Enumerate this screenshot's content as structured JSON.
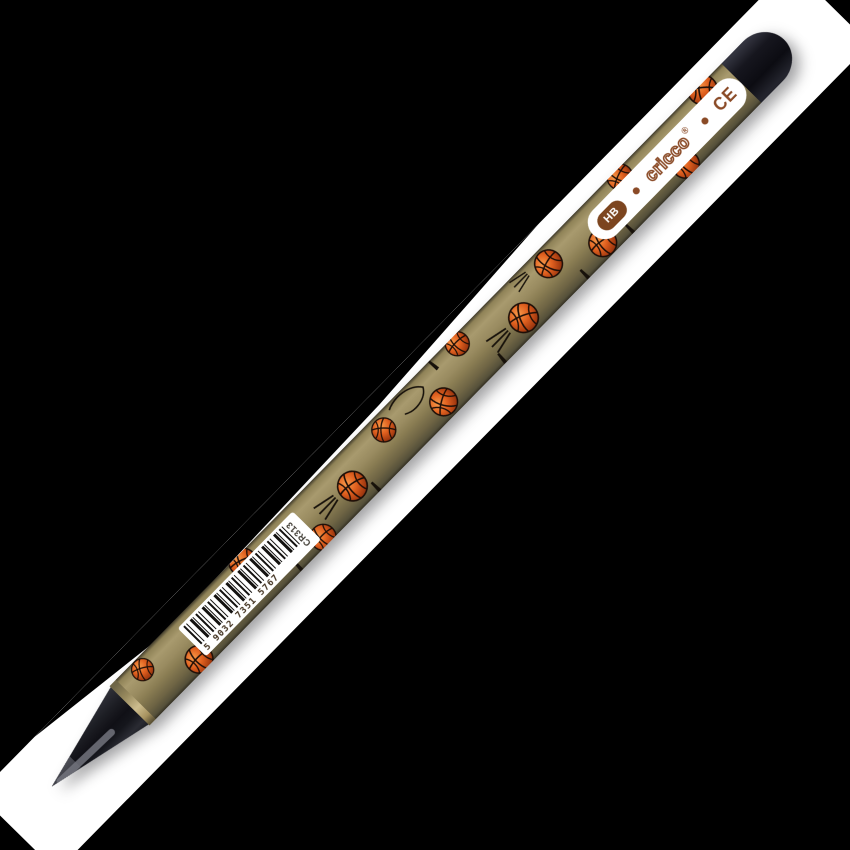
{
  "scene": {
    "type": "product-photo",
    "background_color": "#000000",
    "backdrop_color": "#ffffff",
    "subject": "HB graphite pencil with basketball print lying diagonally on a white strip"
  },
  "pencil": {
    "body_color": "#8a7d53",
    "cap_color": "#14141a",
    "accent_orange": "#e0601f",
    "brand_brown": "#8a4a26",
    "brand": "cricco",
    "registered_mark": "®",
    "ce_mark": "CE",
    "grade": "HB",
    "barcode": {
      "number": "5 9032 7351 5767",
      "product_code": "CR313"
    }
  }
}
